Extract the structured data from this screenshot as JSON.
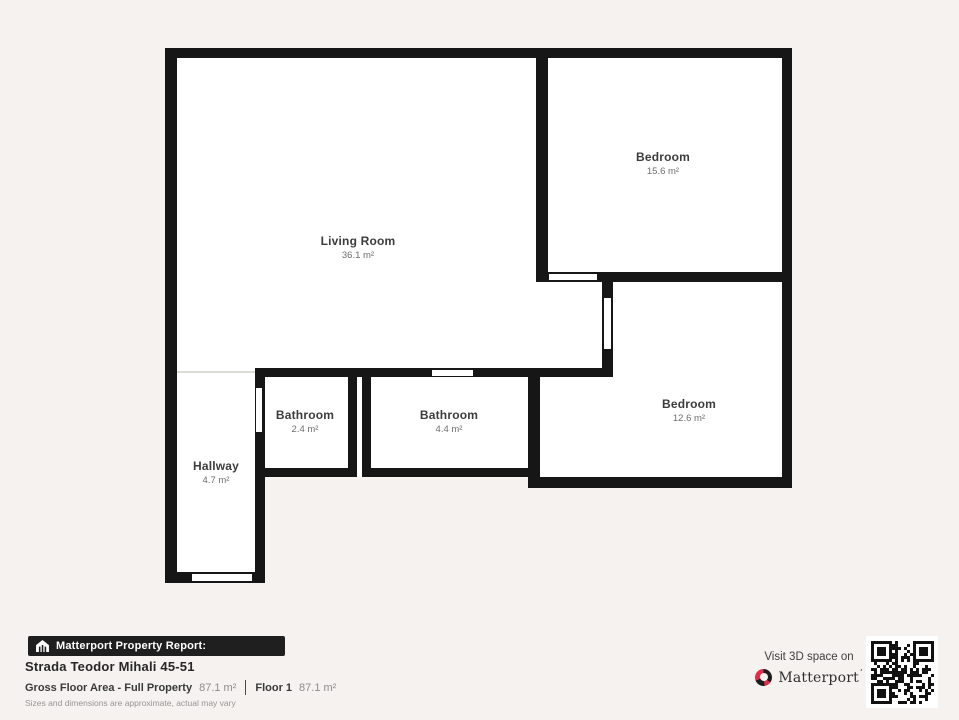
{
  "floorplan": {
    "wall_color": "#161616",
    "floor_color": "#ffffff",
    "rooms": [
      {
        "id": "living-room",
        "name": "Living Room",
        "area": "36.1 m²",
        "x": 358,
        "y": 248
      },
      {
        "id": "bedroom-1",
        "name": "Bedroom",
        "area": "15.6 m²",
        "x": 663,
        "y": 164
      },
      {
        "id": "bedroom-2",
        "name": "Bedroom",
        "area": "12.6 m²",
        "x": 689,
        "y": 411
      },
      {
        "id": "bathroom-1",
        "name": "Bathroom",
        "area": "2.4 m²",
        "x": 305,
        "y": 422
      },
      {
        "id": "bathroom-2",
        "name": "Bathroom",
        "area": "4.4 m²",
        "x": 449,
        "y": 422
      },
      {
        "id": "hallway",
        "name": "Hallway",
        "area": "4.7 m²",
        "x": 216,
        "y": 473
      }
    ],
    "floor_rect": [
      165,
      48,
      627,
      535
    ],
    "outside_notches": [
      [
        265,
        477,
        263,
        106
      ],
      [
        528,
        488,
        264,
        95
      ]
    ],
    "walls": [
      [
        165,
        48,
        627,
        10
      ],
      [
        165,
        48,
        12,
        535
      ],
      [
        782,
        48,
        10,
        440
      ],
      [
        536,
        57,
        12,
        225
      ],
      [
        536,
        272,
        256,
        10
      ],
      [
        602,
        282,
        11,
        95
      ],
      [
        255,
        368,
        358,
        9
      ],
      [
        255,
        368,
        10,
        215
      ],
      [
        348,
        377,
        9,
        100
      ],
      [
        362,
        377,
        9,
        100
      ],
      [
        257,
        468,
        100,
        9
      ],
      [
        362,
        468,
        178,
        9
      ],
      [
        528,
        368,
        12,
        120
      ],
      [
        528,
        477,
        264,
        11
      ],
      [
        165,
        572,
        100,
        11
      ]
    ],
    "door_openings": [
      [
        548,
        273,
        50,
        8
      ],
      [
        603,
        297,
        9,
        53
      ],
      [
        431,
        369,
        43,
        8
      ],
      [
        255,
        387,
        8,
        46
      ],
      [
        191,
        573,
        62,
        9
      ]
    ],
    "open_boundary": [
      177,
      371,
      78,
      2
    ]
  },
  "footer": {
    "badge": {
      "label": "Matterport Property Report:"
    },
    "address": "Strada Teodor Mihali 45-51",
    "stats": [
      {
        "label": "Gross Floor Area - Full Property",
        "value": "87.1 m²"
      },
      {
        "label": "Floor 1",
        "value": "87.1 m²"
      }
    ],
    "disclaimer": "Sizes and dimensions are approximate, actual may vary",
    "cta": {
      "text": "Visit 3D space on",
      "brand": "Matterport",
      "brand_mark": "’",
      "brand_color": "#e02c49"
    }
  }
}
